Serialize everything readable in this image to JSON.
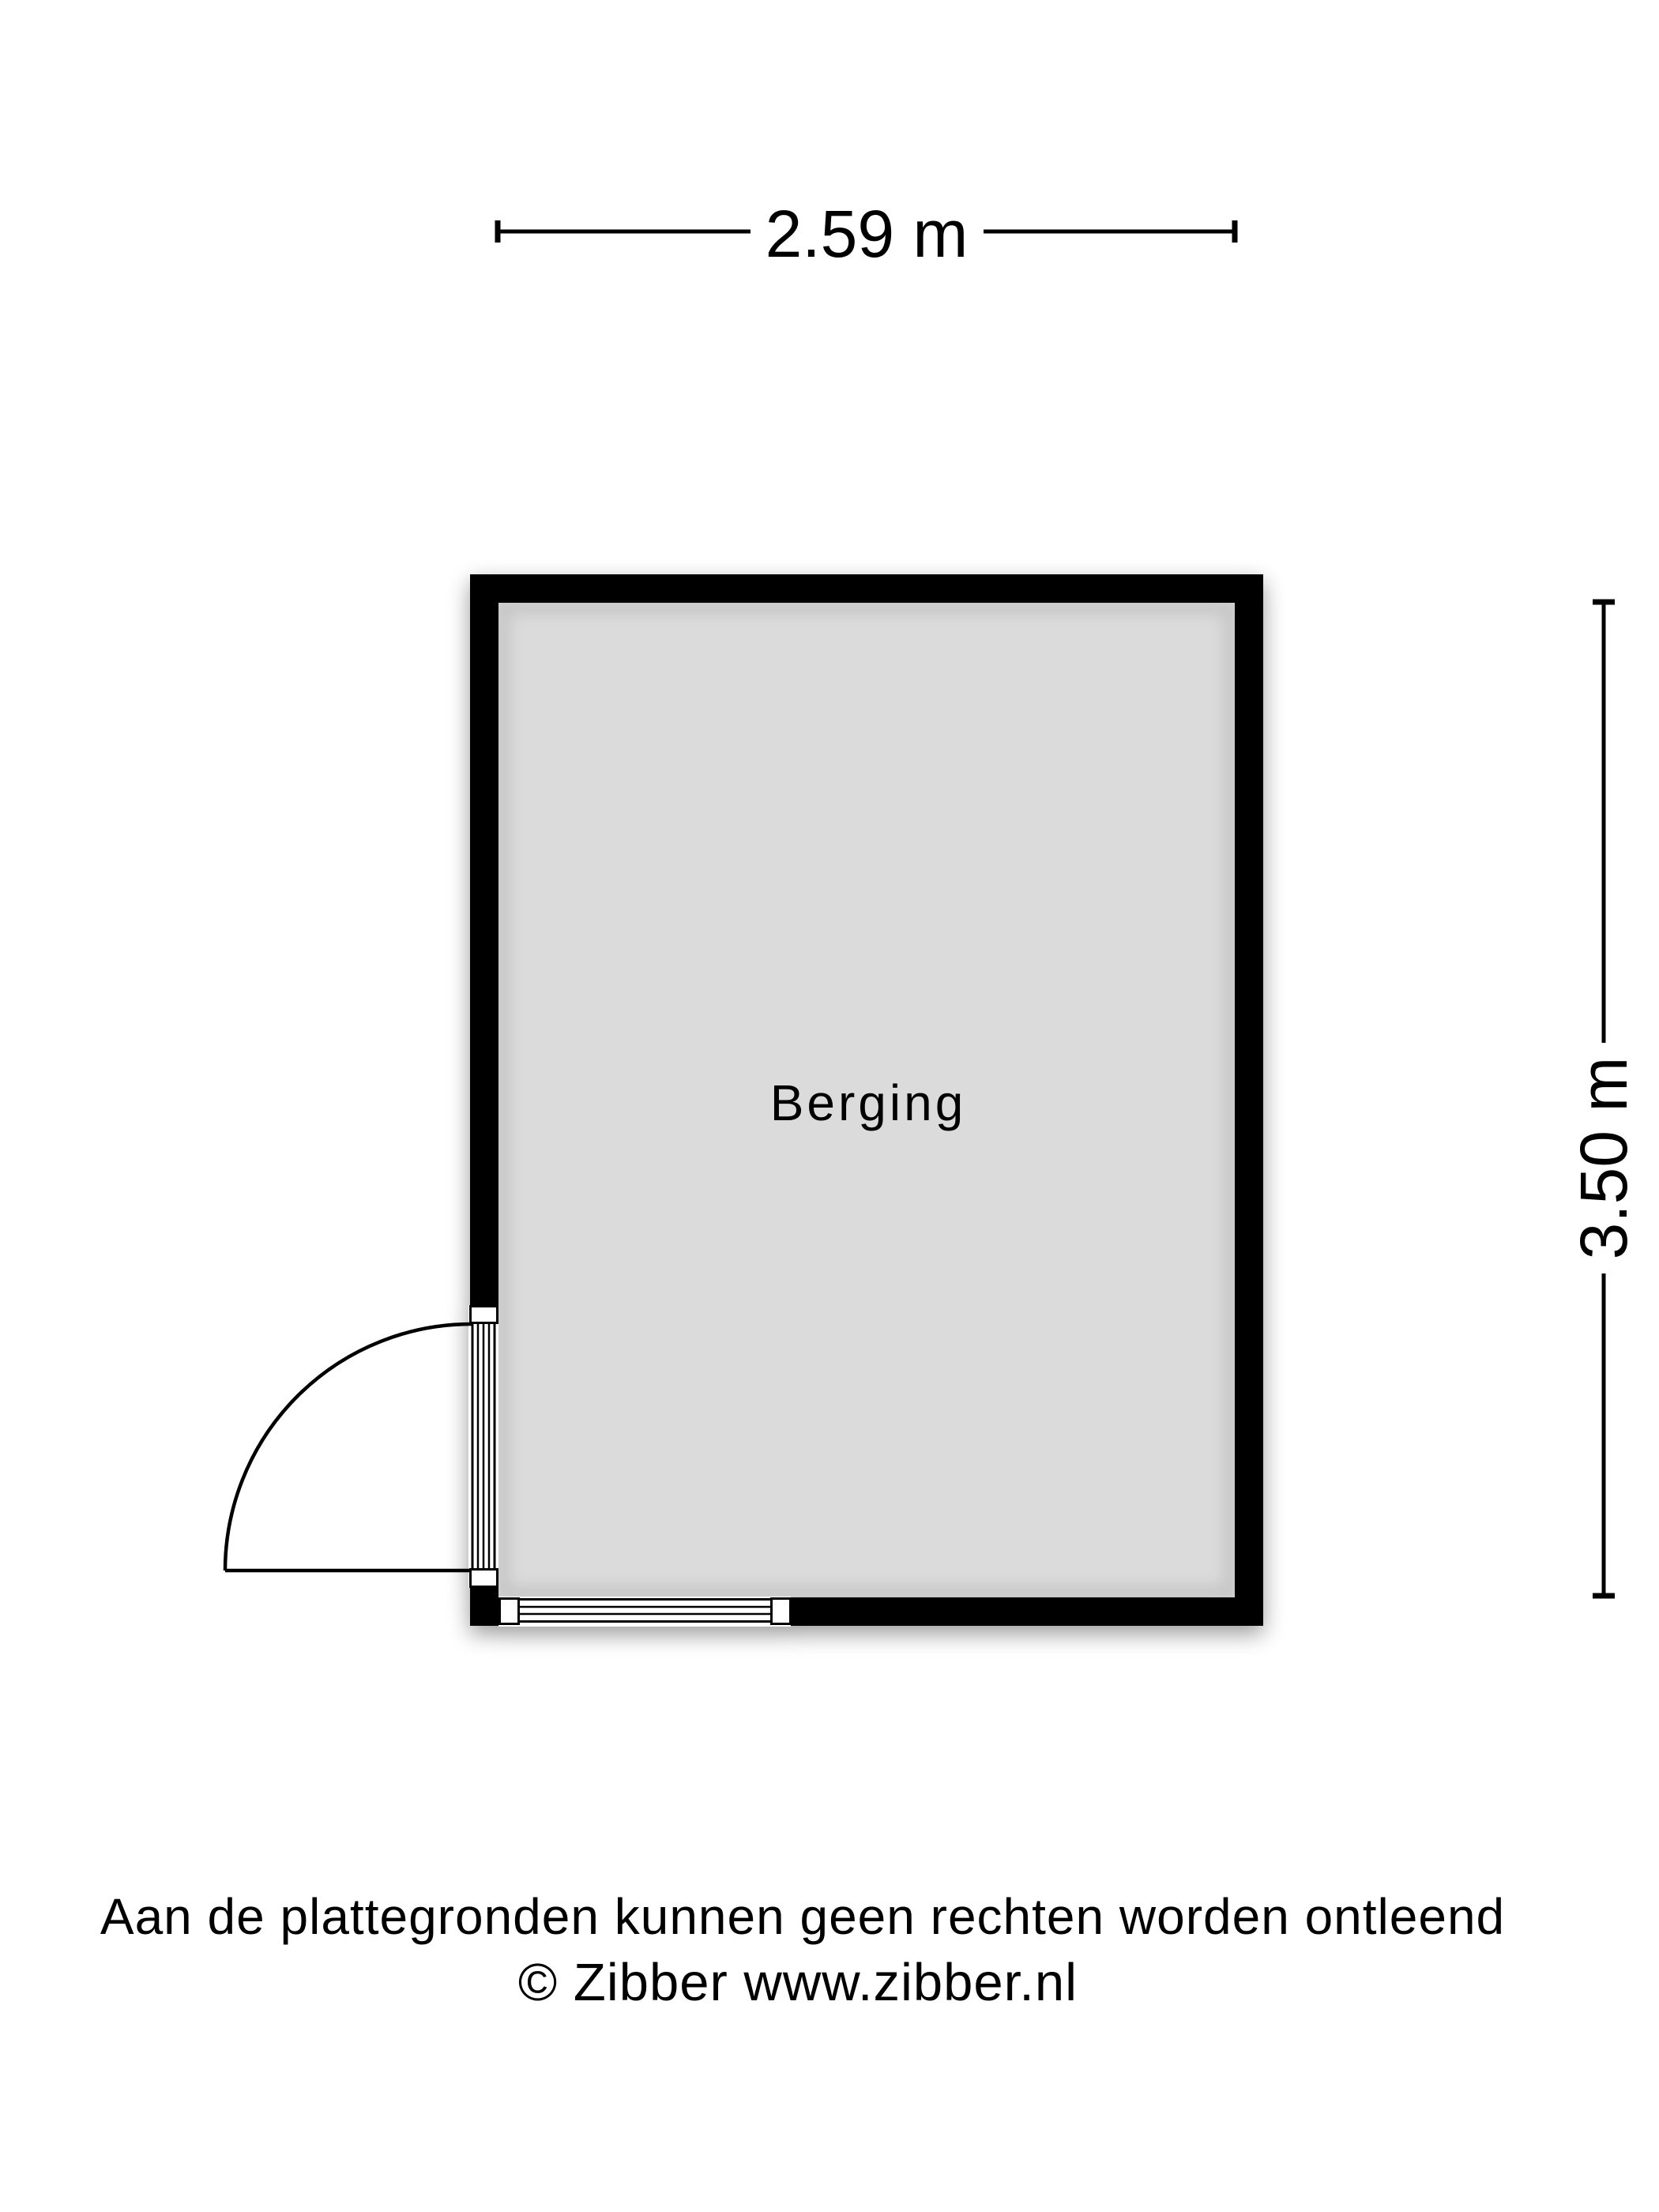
{
  "floorplan": {
    "room_label": "Berging",
    "width_label": "2.59 m",
    "height_label": "3.50 m"
  },
  "footer": {
    "disclaimer": "Aan de plattegronden kunnen geen rechten worden ontleend",
    "copyright": "© Zibber www.zibber.nl"
  },
  "colors": {
    "wall": "#000000",
    "floor": "#dbdbdb",
    "line": "#000000",
    "background": "#ffffff"
  }
}
